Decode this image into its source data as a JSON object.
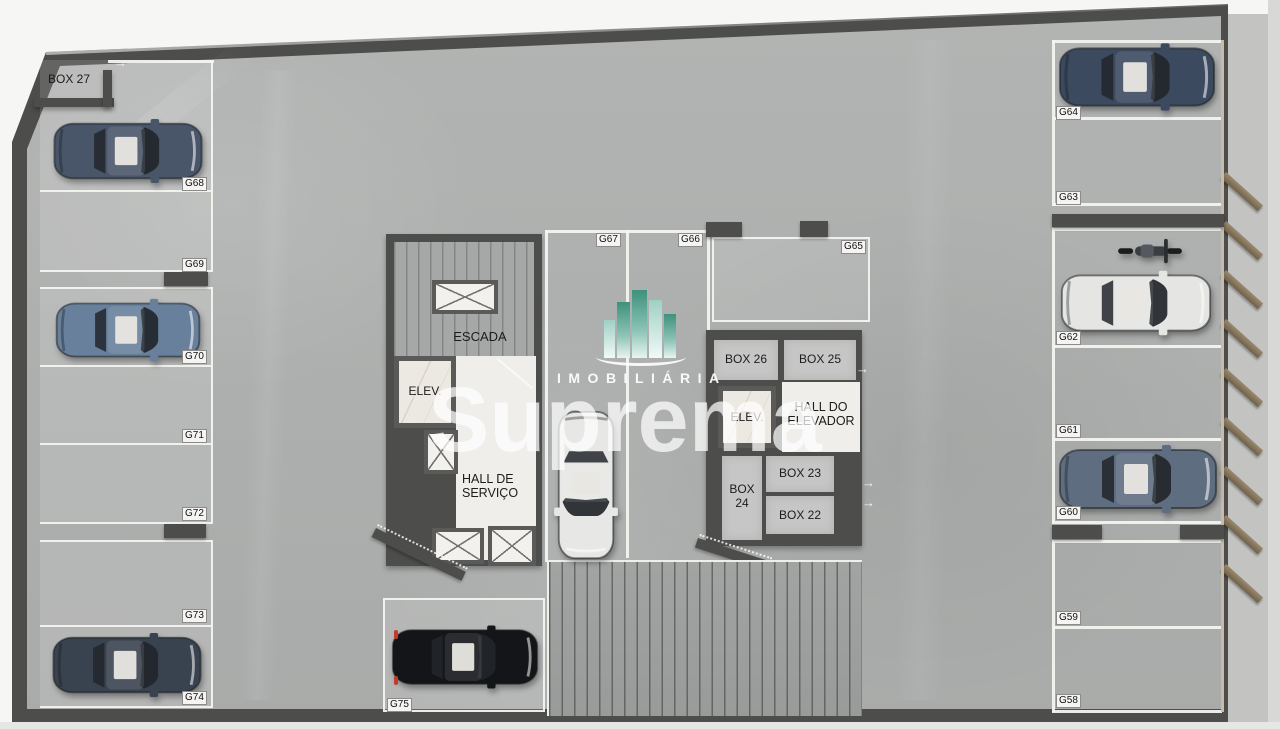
{
  "watermark": {
    "line1": "IMOBILIÁRIA",
    "line2": "Suprema"
  },
  "rooms": {
    "escada": "ESCADA",
    "elev_servico": "ELEV.",
    "hall_servico": "HALL DE SERVIÇO",
    "elev_social": "ELEV.",
    "hall_elevador": "HALL DO ELEVADOR"
  },
  "boxes": {
    "b27": "BOX 27",
    "b26": "BOX 26",
    "b25": "BOX 25",
    "b24": "BOX 24",
    "b23": "BOX 23",
    "b22": "BOX 22"
  },
  "spots": {
    "g58": {
      "label": "G58",
      "vehicle": "empty"
    },
    "g59": {
      "label": "G59",
      "vehicle": "empty"
    },
    "g60": {
      "label": "G60",
      "vehicle": "gray-blue SUV"
    },
    "g61": {
      "label": "G61",
      "vehicle": "empty"
    },
    "g62": {
      "label": "G62",
      "vehicle": "white SUV and motorcycle"
    },
    "g63": {
      "label": "G63",
      "vehicle": "empty"
    },
    "g64": {
      "label": "G64",
      "vehicle": "dark blue sedan"
    },
    "g65": {
      "label": "G65",
      "vehicle": "empty"
    },
    "g66": {
      "label": "G66",
      "vehicle": "empty"
    },
    "g67": {
      "label": "G67",
      "vehicle": "white sedan"
    },
    "g68": {
      "label": "G68",
      "vehicle": "dark blue sedan"
    },
    "g69": {
      "label": "G69",
      "vehicle": "empty"
    },
    "g70": {
      "label": "G70",
      "vehicle": "steel blue sedan"
    },
    "g71": {
      "label": "G71",
      "vehicle": "empty"
    },
    "g72": {
      "label": "G72",
      "vehicle": "empty"
    },
    "g73": {
      "label": "G73",
      "vehicle": "empty"
    },
    "g74": {
      "label": "G74",
      "vehicle": "dark gray sedan"
    },
    "g75": {
      "label": "G75",
      "vehicle": "black hatchback"
    }
  },
  "colors": {
    "floor": "#adafae",
    "wall": "#4d4d4b",
    "stall_line": "#f2f2ef",
    "logo_green": "#3e917c",
    "louver": "#8a795f",
    "white_room": "#efeeeb"
  }
}
